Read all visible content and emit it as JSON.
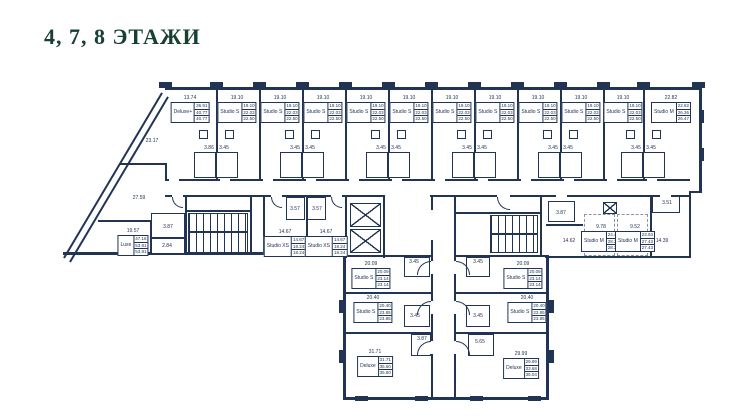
{
  "title": "4, 7, 8 ЭТАЖИ",
  "colors": {
    "title_green": "#17402f",
    "wall_navy": "#223454",
    "background": "#ffffff"
  },
  "units": [
    {
      "type": "Deluxe+",
      "dim": "13.74",
      "a1": "36.91",
      "a2": "40.77",
      "a3": "40.77",
      "x": 190,
      "y": 95
    },
    {
      "type": "Studio S",
      "dim": "19.10",
      "a1": "19.10",
      "a2": "22.03",
      "a3": "22.50",
      "x": 237,
      "y": 95
    },
    {
      "type": "Studio S",
      "dim": "19.10",
      "a1": "19.10",
      "a2": "22.03",
      "a3": "22.50",
      "x": 280,
      "y": 95
    },
    {
      "type": "Studio S",
      "dim": "19.10",
      "a1": "19.10",
      "a2": "22.03",
      "a3": "22.50",
      "x": 323,
      "y": 95
    },
    {
      "type": "Studio S",
      "dim": "19.10",
      "a1": "19.10",
      "a2": "22.03",
      "a3": "22.50",
      "x": 366,
      "y": 95
    },
    {
      "type": "Studio S",
      "dim": "19.10",
      "a1": "19.10",
      "a2": "22.03",
      "a3": "22.50",
      "x": 409,
      "y": 95
    },
    {
      "type": "Studio S",
      "dim": "19.10",
      "a1": "19.10",
      "a2": "22.03",
      "a3": "22.50",
      "x": 452,
      "y": 95
    },
    {
      "type": "Studio S",
      "dim": "19.10",
      "a1": "19.10",
      "a2": "22.03",
      "a3": "22.50",
      "x": 495,
      "y": 95
    },
    {
      "type": "Studio S",
      "dim": "19.10",
      "a1": "19.10",
      "a2": "22.03",
      "a3": "22.50",
      "x": 538,
      "y": 95
    },
    {
      "type": "Studio S",
      "dim": "19.10",
      "a1": "19.10",
      "a2": "22.03",
      "a3": "22.50",
      "x": 581,
      "y": 95
    },
    {
      "type": "Studio S",
      "dim": "19.10",
      "a1": "19.10",
      "a2": "22.03",
      "a3": "22.50",
      "x": 623,
      "y": 95
    },
    {
      "type": "Studio M",
      "dim": "22.82",
      "a1": "22.82",
      "a2": "26.36",
      "a3": "26.47",
      "x": 671,
      "y": 95
    },
    {
      "type": "Luxe",
      "dim": "19.57",
      "a1": "47.16",
      "a2": "53.81",
      "a3": "53.81",
      "x": 133,
      "y": 228
    },
    {
      "type": "Studio XS",
      "dim": "14.67",
      "a1": "14.67",
      "a2": "18.24",
      "a3": "18.24",
      "x": 285,
      "y": 229
    },
    {
      "type": "Studio XS",
      "dim": "14.67",
      "a1": "14.67",
      "a2": "18.24",
      "a3": "18.24",
      "x": 326,
      "y": 229
    },
    {
      "type": "Studio M",
      "dim": "9.78",
      "a1": "24.40",
      "a2": "28.22",
      "a3": "28.22",
      "x": 601,
      "y": 224
    },
    {
      "type": "Studio M",
      "dim": "9.52",
      "a1": "23.93",
      "a2": "27.43",
      "a3": "27.43",
      "x": 635,
      "y": 224
    },
    {
      "type": "Studio S",
      "dim": "20.09",
      "a1": "20.09",
      "a2": "23.14",
      "a3": "23.14",
      "x": 371,
      "y": 261
    },
    {
      "type": "Studio S",
      "dim": "20.09",
      "a1": "20.09",
      "a2": "23.14",
      "a3": "23.14",
      "x": 523,
      "y": 261
    },
    {
      "type": "Studio S",
      "dim": "20.40",
      "a1": "20.40",
      "a2": "23.85",
      "a3": "23.85",
      "x": 373,
      "y": 295
    },
    {
      "type": "Studio S",
      "dim": "20.40",
      "a1": "20.40",
      "a2": "23.85",
      "a3": "23.85",
      "x": 527,
      "y": 295
    },
    {
      "type": "Deluxe",
      "dim": "31.71",
      "a1": "31.71",
      "a2": "35.60",
      "a3": "35.60",
      "x": 375,
      "y": 349
    },
    {
      "type": "Deluxe",
      "dim": "29.99",
      "a1": "29.99",
      "a2": "33.68",
      "a3": "35.04",
      "x": 521,
      "y": 351
    }
  ],
  "labels": [
    {
      "t": "23.17",
      "x": 152,
      "y": 141
    },
    {
      "t": "27.59",
      "x": 139,
      "y": 198
    },
    {
      "t": "3.87",
      "x": 168,
      "y": 227
    },
    {
      "t": "2.84",
      "x": 167,
      "y": 246
    },
    {
      "t": "3.86",
      "x": 209,
      "y": 148
    },
    {
      "t": "3.45",
      "x": 224,
      "y": 148
    },
    {
      "t": "3.45",
      "x": 295,
      "y": 148
    },
    {
      "t": "3.45",
      "x": 310,
      "y": 148
    },
    {
      "t": "3.45",
      "x": 381,
      "y": 148
    },
    {
      "t": "3.45",
      "x": 396,
      "y": 148
    },
    {
      "t": "3.45",
      "x": 467,
      "y": 148
    },
    {
      "t": "3.45",
      "x": 482,
      "y": 148
    },
    {
      "t": "3.45",
      "x": 553,
      "y": 148
    },
    {
      "t": "3.45",
      "x": 568,
      "y": 148
    },
    {
      "t": "3.45",
      "x": 636,
      "y": 148
    },
    {
      "t": "3.45",
      "x": 651,
      "y": 148
    },
    {
      "t": "3.57",
      "x": 295,
      "y": 209
    },
    {
      "t": "3.57",
      "x": 317,
      "y": 209
    },
    {
      "t": "3.87",
      "x": 561,
      "y": 213
    },
    {
      "t": "3.51",
      "x": 667,
      "y": 203
    },
    {
      "t": "14.62",
      "x": 569,
      "y": 241
    },
    {
      "t": "14.39",
      "x": 662,
      "y": 241
    },
    {
      "t": "3.45",
      "x": 414,
      "y": 262
    },
    {
      "t": "3.45",
      "x": 478,
      "y": 262
    },
    {
      "t": "3.45",
      "x": 415,
      "y": 316
    },
    {
      "t": "3.45",
      "x": 478,
      "y": 316
    },
    {
      "t": "3.87",
      "x": 422,
      "y": 339
    },
    {
      "t": "5.65",
      "x": 480,
      "y": 342
    }
  ]
}
